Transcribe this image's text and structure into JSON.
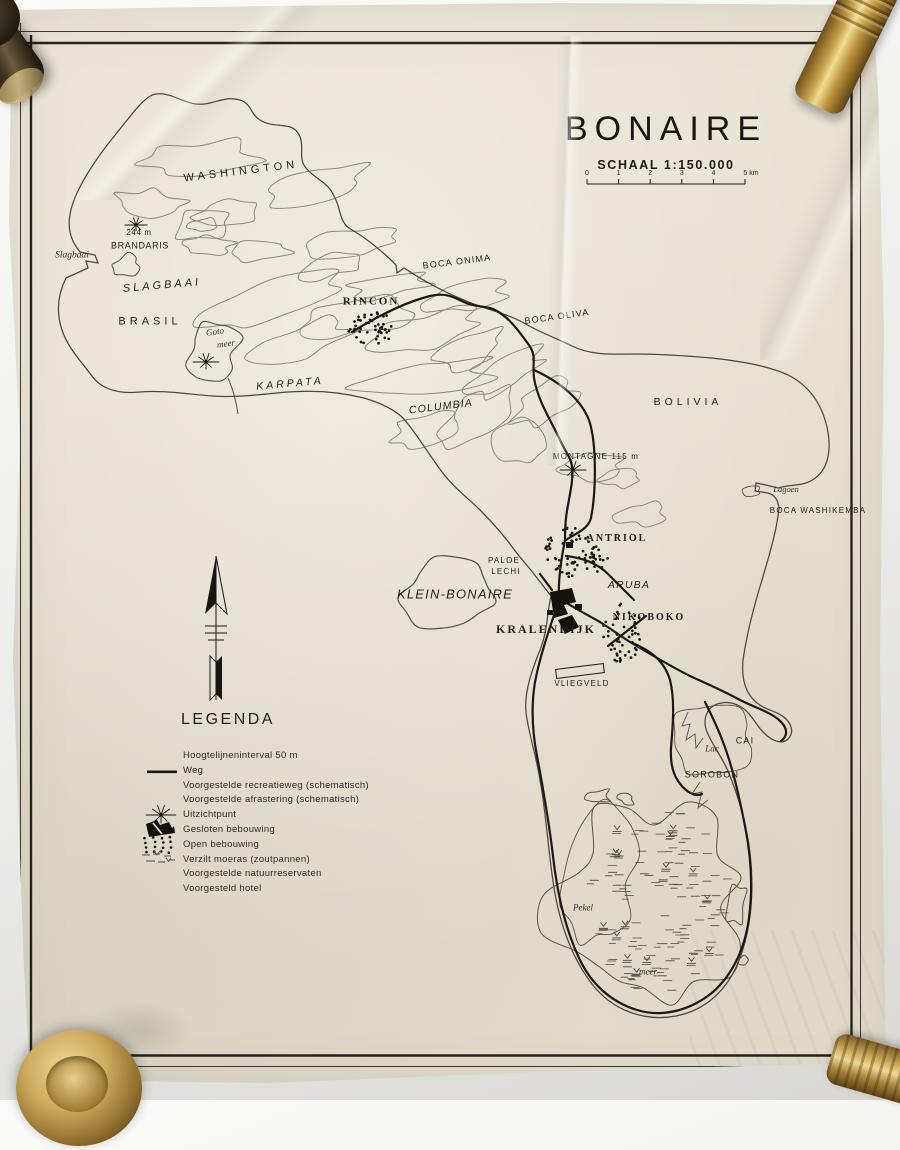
{
  "title": "BONAIRE",
  "scale": {
    "label": "SCHAAL 1:150.000",
    "unit_ticks": [
      "0",
      "1",
      "2",
      "3",
      "4",
      "5 km"
    ]
  },
  "legend": {
    "title": "LEGENDA",
    "items": [
      {
        "symbol": "none",
        "label": "Hoogtelijneninterval 50 m"
      },
      {
        "symbol": "road-line",
        "label": "Weg"
      },
      {
        "symbol": "none",
        "label": "Voorgestelde recreatieweg (schematisch)"
      },
      {
        "symbol": "none",
        "label": "Voorgestelde afrastering (schematisch)"
      },
      {
        "symbol": "viewpoint-star",
        "label": "Uitzichtpunt"
      },
      {
        "symbol": "closed-settlement",
        "label": "Gesloten bebouwing"
      },
      {
        "symbol": "open-settlement-dots",
        "label": "Open bebouwing"
      },
      {
        "symbol": "salt-marsh",
        "label": "Verzilt moeras (zoutpannen)"
      },
      {
        "symbol": "none",
        "label": "Voorgestelde natuurreservaten"
      },
      {
        "symbol": "none",
        "label": "Voorgesteld hotel"
      }
    ]
  },
  "map_labels": [
    {
      "text": "WASHINGTON",
      "x": 241,
      "y": 172,
      "cls": "sp",
      "size": 11,
      "rot": -7
    },
    {
      "text": "244 m",
      "x": 139,
      "y": 233,
      "cls": "small",
      "size": 8,
      "rot": 0
    },
    {
      "text": "BRANDARIS",
      "x": 140,
      "y": 246,
      "cls": "small",
      "size": 9,
      "rot": 0
    },
    {
      "text": "Slagbaai",
      "x": 72,
      "y": 256,
      "cls": "italic",
      "size": 9.5,
      "rot": 0
    },
    {
      "text": "SLAGBAAI",
      "x": 162,
      "y": 286,
      "cls": "sp-it",
      "size": 11,
      "rot": -5
    },
    {
      "text": "BRASIL",
      "x": 150,
      "y": 322,
      "cls": "sp",
      "size": 11,
      "rot": 0
    },
    {
      "text": "Goto",
      "x": 215,
      "y": 332,
      "cls": "italic",
      "size": 9,
      "rot": -8
    },
    {
      "text": "meer",
      "x": 226,
      "y": 344,
      "cls": "italic",
      "size": 9,
      "rot": -8
    },
    {
      "text": "KARPATA",
      "x": 290,
      "y": 384,
      "cls": "sp-it",
      "size": 10.5,
      "rot": -5
    },
    {
      "text": "RINCON",
      "x": 371,
      "y": 302,
      "cls": "serif",
      "size": 11,
      "rot": 0
    },
    {
      "text": "BOCA ONIMA",
      "x": 457,
      "y": 262,
      "cls": "sans",
      "size": 9,
      "rot": -7
    },
    {
      "text": "BOCA OLIVA",
      "x": 557,
      "y": 317,
      "cls": "sans",
      "size": 9,
      "rot": -8
    },
    {
      "text": "COLUMBIA",
      "x": 441,
      "y": 407,
      "cls": "sans-it",
      "size": 10.5,
      "rot": -7
    },
    {
      "text": "BOLIVIA",
      "x": 688,
      "y": 402,
      "cls": "sp",
      "size": 10.5,
      "rot": 0
    },
    {
      "text": "MONTAGNE 115 m",
      "x": 596,
      "y": 457,
      "cls": "sans",
      "size": 8,
      "rot": 0
    },
    {
      "text": "Lagoen",
      "x": 786,
      "y": 489,
      "cls": "italic",
      "size": 8.5,
      "rot": 0
    },
    {
      "text": "BOCA WASHIKEMBA",
      "x": 818,
      "y": 511,
      "cls": "sans",
      "size": 8,
      "rot": 0
    },
    {
      "text": "ANTRIOL",
      "x": 617,
      "y": 539,
      "cls": "serif",
      "size": 10,
      "rot": 0
    },
    {
      "text": "ARUBA",
      "x": 629,
      "y": 585,
      "cls": "sans-it",
      "size": 10.5,
      "rot": 0
    },
    {
      "text": "PALOE",
      "x": 504,
      "y": 561,
      "cls": "sans",
      "size": 8,
      "rot": 0
    },
    {
      "text": "LECHI",
      "x": 506,
      "y": 572,
      "cls": "sans",
      "size": 8,
      "rot": 0
    },
    {
      "text": "KLEIN-BONAIRE",
      "x": 455,
      "y": 594,
      "cls": "sans-it",
      "size": 13,
      "rot": 0
    },
    {
      "text": "KRALENDIJK",
      "x": 546,
      "y": 629,
      "cls": "serif",
      "size": 12,
      "rot": 0
    },
    {
      "text": "NIKOBOKO",
      "x": 649,
      "y": 618,
      "cls": "serif",
      "size": 10,
      "rot": 0
    },
    {
      "text": "VLIEGVELD",
      "x": 582,
      "y": 684,
      "cls": "sans",
      "size": 8,
      "rot": 0
    },
    {
      "text": "Lac",
      "x": 712,
      "y": 749,
      "cls": "italic",
      "size": 9,
      "rot": 0
    },
    {
      "text": "CAI",
      "x": 745,
      "y": 741,
      "cls": "sans",
      "size": 9,
      "rot": 0
    },
    {
      "text": "SOROBON",
      "x": 712,
      "y": 775,
      "cls": "sans",
      "size": 9,
      "rot": 0
    },
    {
      "text": "Pekel",
      "x": 583,
      "y": 908,
      "cls": "italic",
      "size": 9,
      "rot": 0
    },
    {
      "text": "meer",
      "x": 648,
      "y": 972,
      "cls": "italic",
      "size": 9,
      "rot": 0
    }
  ],
  "margin_note": {
    "top": "60 cm",
    "bottom": "30 cm"
  },
  "colors": {
    "paper": "#e9e3d4",
    "ink": "#1b1913",
    "contour": "#8c897c",
    "coast": "#4a463c",
    "brass": "#c9a44e"
  }
}
